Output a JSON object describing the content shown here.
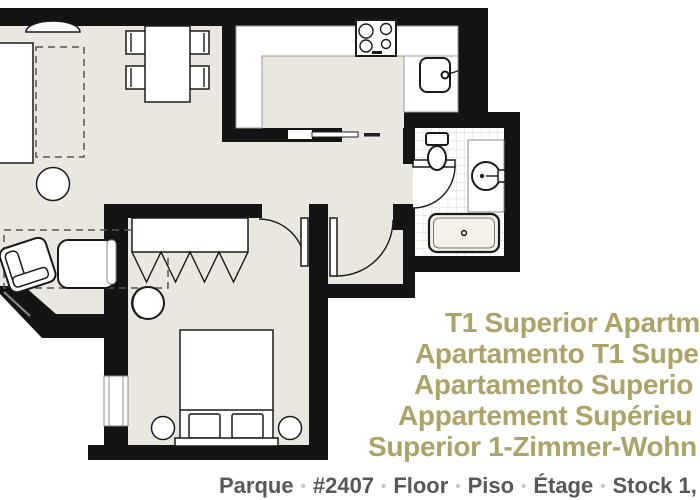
{
  "title": {
    "lines": [
      "T1 Superior Apartm",
      "Apartamento T1 Supe",
      "Apartamento Superio",
      "Appartement Supérieu",
      "Superior 1-Zimmer-Wohn"
    ]
  },
  "footer": {
    "items": [
      "Parque",
      "#2407",
      "Floor",
      "Piso",
      "Étage",
      "Stock 1,"
    ],
    "separator": "•"
  },
  "colors": {
    "floor": "#eae7e0",
    "wall": "#141414",
    "tile_line": "#d9d6cd",
    "title": "#ada267",
    "footer_text": "#57585b",
    "footer_sep": "#c9c8c3"
  }
}
